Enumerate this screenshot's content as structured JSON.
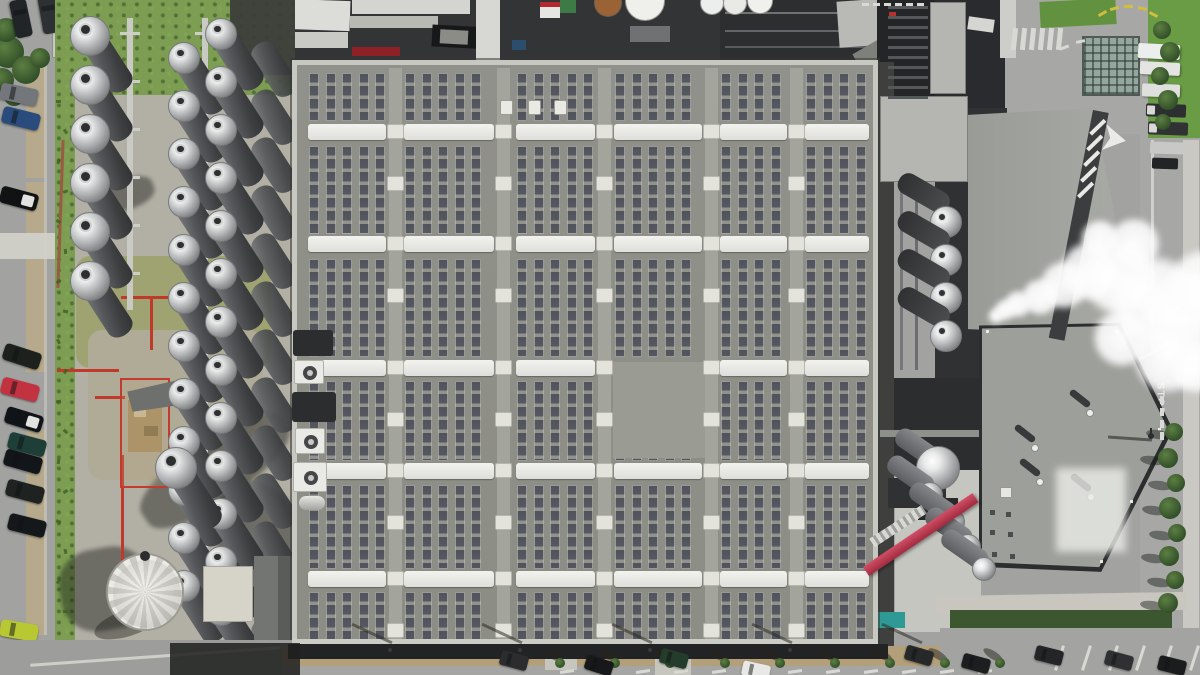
{
  "scene_label": "Aerial view of an industrial plant: large rooftop solar array, tank farm with silver storage tanks, steam plume, roads and parked cars",
  "road_markings": {
    "stop_label": "STOP"
  },
  "palette": {
    "asphalt": "#a2a3a1",
    "concrete": "#b2afa4",
    "grass": "#7c9d52",
    "roof": "#8f9087",
    "roof_border": "#c7c8c1",
    "panel": "#51535b",
    "skylight": "#efefec",
    "dark_ground": "#323436",
    "charcoal": "#27292c",
    "steam": "#ffffff",
    "red_accent": "#c0392b",
    "conveyor_pink": "#c2455e",
    "teal": "#2f9a95",
    "hedge": "#3c572f",
    "dirt": "#b3a07a",
    "right_roof": "#9d9f9a"
  },
  "left_road": {
    "cars": [
      [
        2,
        10,
        78,
        "#222527",
        0
      ],
      [
        30,
        6,
        80,
        "#2e3134",
        0
      ],
      [
        0,
        86,
        12,
        "#73767a",
        0
      ],
      [
        2,
        110,
        14,
        "#2a4c7c",
        0
      ],
      [
        0,
        190,
        15,
        "#101214",
        1
      ],
      [
        3,
        348,
        18,
        "#1c211e",
        0
      ],
      [
        1,
        381,
        15,
        "#c33240",
        0
      ],
      [
        5,
        411,
        17,
        "#101418",
        1
      ],
      [
        8,
        436,
        15,
        "#1d3f38",
        0
      ],
      [
        4,
        453,
        16,
        "#121519",
        0
      ],
      [
        6,
        483,
        15,
        "#1e2220",
        0
      ],
      [
        8,
        517,
        14,
        "#15181b",
        0
      ],
      [
        0,
        622,
        10,
        "#b7c832",
        0
      ],
      [
        0,
        656,
        8,
        "#dfe0dc",
        0
      ]
    ],
    "sidewalk_segments": [
      [
        26,
        60,
        20,
        118
      ],
      [
        26,
        182,
        20,
        190
      ],
      [
        26,
        430,
        20,
        205
      ]
    ],
    "walkway": [
      0,
      233,
      58,
      26
    ],
    "bushes": [
      [
        8,
        52,
        16
      ],
      [
        26,
        70,
        14
      ],
      [
        2,
        80,
        12
      ],
      [
        40,
        58,
        10
      ],
      [
        14,
        96,
        10
      ],
      [
        6,
        30,
        12
      ]
    ],
    "corner_building": [
      52,
      0,
      92,
      58
    ]
  },
  "tank_yard": {
    "grass_top": [
      55,
      0,
      240,
      95
    ],
    "grass_strip": [
      55,
      90,
      20,
      560
    ],
    "mid_patch_grass": [
      76,
      256,
      195,
      112
    ],
    "mid_patch_dirt": [
      88,
      330,
      175,
      150
    ],
    "columns": [
      {
        "cx": 90,
        "start_y": 36,
        "dy": 49,
        "count": 6,
        "r": 20
      },
      {
        "cx": 258,
        "start_y": 44,
        "dy": 48,
        "count": 13,
        "r": 0
      },
      {
        "cx": 184,
        "start_y": 58,
        "dy": 48,
        "count": 12,
        "r": 16
      },
      {
        "cx": 221,
        "start_y": 34,
        "dy": 48,
        "count": 13,
        "r": 16
      }
    ],
    "body": {
      "w": 27,
      "len": 64,
      "angle": -33
    },
    "big_horiz_tank": {
      "cx": 176,
      "cy": 468,
      "r": 21,
      "len": 70
    },
    "lattices": [
      [
        127,
        18,
        292
      ],
      [
        202,
        18,
        612
      ]
    ],
    "silo": {
      "cx": 145,
      "cy": 592,
      "r": 39
    },
    "shed_roof": [
      128,
      382,
      62,
      26,
      -8
    ],
    "red_enclosure": [
      120,
      378,
      50,
      110
    ],
    "clutter": [
      128,
      400,
      34,
      52
    ],
    "red_lines": [
      [
        57,
        369,
        62,
        3
      ],
      [
        95,
        396,
        30,
        3
      ],
      [
        121,
        296,
        86,
        3
      ],
      [
        150,
        296,
        3,
        54
      ],
      [
        121,
        455,
        3,
        108
      ]
    ],
    "rust_pipe": [
      59,
      140,
      3,
      148
    ],
    "pale_building": [
      203,
      566,
      50,
      56
    ],
    "gray_block": [
      254,
      556,
      40,
      88
    ],
    "dark_blocks": [
      [
        190,
        640,
        105,
        35
      ],
      [
        230,
        0,
        65,
        75
      ]
    ],
    "shadows": [
      [
        130,
        440,
        170,
        60,
        -35
      ],
      [
        60,
        548,
        90,
        82,
        -10
      ],
      [
        228,
        478,
        90,
        160,
        -30
      ],
      [
        95,
        180,
        60,
        30,
        -20
      ]
    ]
  },
  "solar_roof": {
    "x": 292,
    "y": 60,
    "w": 586,
    "h": 590,
    "skylight_rows": [
      124,
      236,
      360,
      463,
      571
    ],
    "skylight_h": 16,
    "pad_rows": [
      124,
      176,
      236,
      288,
      360,
      412,
      463,
      515,
      571,
      623
    ],
    "bands": [
      [
        73,
        121
      ],
      [
        146,
        234
      ],
      [
        259,
        357
      ],
      [
        381,
        461
      ],
      [
        485,
        569
      ],
      [
        592,
        642
      ]
    ],
    "blocks": [
      [
        307,
        387
      ],
      [
        403,
        495
      ],
      [
        515,
        596
      ],
      [
        613,
        703
      ],
      [
        719,
        788
      ],
      [
        804,
        870
      ]
    ],
    "walkways": [
      389,
      497,
      598,
      705,
      790
    ],
    "walkway_w": 13,
    "strip_pitch": 16.5,
    "strip_w": 10,
    "bare_patch": [
      613,
      362,
      92,
      96
    ],
    "bare_skylight": {
      "row": 2,
      "block": 3
    },
    "vents": [
      [
        500,
        100
      ],
      [
        528,
        100
      ],
      [
        554,
        100
      ]
    ],
    "hvac": [
      [
        293,
        330,
        40,
        26,
        "dark"
      ],
      [
        294,
        360,
        30,
        24,
        "fan"
      ],
      [
        292,
        392,
        44,
        30,
        "dark"
      ],
      [
        295,
        428,
        30,
        26,
        "fan"
      ],
      [
        293,
        462,
        34,
        30,
        "fan"
      ],
      [
        299,
        496,
        26,
        14,
        "tank"
      ]
    ]
  },
  "top_strip": {
    "base": [
      282,
      0,
      600,
      64
    ],
    "rects": [
      [
        286,
        0,
        64,
        30,
        "#dcddd8",
        2
      ],
      [
        292,
        32,
        56,
        16,
        "#c9cac5",
        0
      ],
      [
        352,
        0,
        118,
        14,
        "#d4d5d0",
        0
      ],
      [
        350,
        16,
        88,
        12,
        "#b8b9b4",
        0
      ],
      [
        352,
        47,
        48,
        9,
        "#8e2126",
        0
      ],
      [
        432,
        26,
        60,
        22,
        "#17181a",
        3
      ],
      [
        440,
        30,
        28,
        14,
        "#8b8c88",
        3
      ],
      [
        476,
        0,
        24,
        62,
        "#d7d8d3",
        0
      ],
      [
        512,
        40,
        14,
        10,
        "#2b4d6e",
        0
      ],
      [
        540,
        2,
        20,
        16,
        "#e6e7e3",
        0
      ],
      [
        540,
        2,
        20,
        5,
        "#b3282e",
        0
      ],
      [
        560,
        0,
        16,
        13,
        "#3e7a45",
        0
      ],
      [
        630,
        26,
        40,
        16,
        "#6f7173",
        0
      ],
      [
        720,
        0,
        158,
        62,
        "#2c2e30",
        0
      ],
      [
        725,
        12,
        150,
        2,
        "#6f7172",
        0
      ],
      [
        725,
        30,
        150,
        2,
        "#63656a",
        0
      ],
      [
        725,
        46,
        150,
        2,
        "#585a5e",
        0
      ],
      [
        838,
        0,
        50,
        46,
        "#b9bab5",
        -4
      ],
      [
        855,
        44,
        36,
        20,
        "#7e807c",
        -30
      ]
    ],
    "circles": [
      [
        608,
        3,
        14,
        "#9a6335"
      ],
      [
        645,
        1,
        20,
        "#eff0ec"
      ],
      [
        712,
        3,
        12,
        "#eceded"
      ],
      [
        735,
        3,
        12,
        "#e9eae6"
      ],
      [
        760,
        1,
        13,
        "#f0f1ed"
      ]
    ]
  },
  "right_area": {
    "rects": [
      [
        877,
        0,
        130,
        124,
        "#292b2e",
        0
      ],
      [
        877,
        0,
        58,
        108,
        "#232527",
        0
      ],
      [
        1005,
        0,
        195,
        134,
        "#a7a8a6",
        0
      ],
      [
        1140,
        120,
        60,
        555,
        "#a7a8a6",
        0
      ],
      [
        1183,
        140,
        16,
        520,
        "#c9c8c2",
        0
      ],
      [
        1040,
        0,
        76,
        26,
        "#62923f",
        -3
      ],
      [
        1148,
        0,
        52,
        138,
        "#6a9c45",
        0
      ],
      [
        1000,
        0,
        16,
        58,
        "#cdcec9",
        0
      ],
      [
        960,
        108,
        12,
        230,
        "#7b7d79",
        0
      ],
      [
        935,
        108,
        72,
        272,
        "#2f3133",
        0
      ],
      [
        878,
        378,
        127,
        96,
        "#2b2d2f",
        0
      ],
      [
        878,
        62,
        16,
        585,
        "#3f403e",
        0
      ],
      [
        900,
        120,
        3,
        250,
        "#75777a",
        0
      ],
      [
        915,
        150,
        3,
        220,
        "#6a6c6f",
        0
      ],
      [
        880,
        150,
        55,
        4,
        "#85878a",
        0
      ],
      [
        895,
        470,
        86,
        162,
        "#c6c6c0",
        0
      ],
      [
        888,
        478,
        58,
        30,
        "#2f3133",
        0
      ],
      [
        918,
        498,
        40,
        22,
        "#27292b",
        0
      ],
      [
        873,
        612,
        32,
        16,
        "#2f9a95",
        0
      ],
      [
        936,
        594,
        250,
        18,
        "#c8c6bf",
        -1
      ],
      [
        950,
        610,
        222,
        18,
        "#3c572f",
        0
      ],
      [
        1128,
        350,
        52,
        3,
        "#d5d6d2",
        -28
      ],
      [
        1151,
        140,
        3,
        215,
        "#cfd0cb",
        0
      ],
      [
        968,
        18,
        26,
        13,
        "#d5d6d2",
        8
      ],
      [
        889,
        12,
        7,
        7,
        "#b3332c",
        0
      ],
      [
        880,
        430,
        122,
        7,
        "#8e908b",
        0
      ]
    ],
    "lattice_rects": [
      [
        930,
        2,
        36,
        92
      ],
      [
        880,
        96,
        88,
        86
      ]
    ],
    "glass_building": [
      1082,
      36,
      58,
      60
    ],
    "trailers": [
      [
        1138,
        44,
        42,
        15,
        "#eceded",
        3
      ],
      [
        1140,
        62,
        40,
        13,
        "#e4e5e3",
        3
      ],
      [
        1142,
        84,
        38,
        13,
        "#dfe0de",
        2
      ]
    ],
    "trucks": [
      [
        1146,
        104,
        40,
        13,
        "#2c2e30",
        1
      ],
      [
        1148,
        122,
        40,
        13,
        "#303234",
        1
      ],
      [
        1150,
        142,
        34,
        12,
        "#c8c9c6",
        0
      ],
      [
        1152,
        158,
        26,
        11,
        "#222426",
        0
      ]
    ],
    "upper_roof": [
      968,
      108,
      172,
      228
    ],
    "lower_roof": [
      982,
      326,
      186,
      246
    ],
    "edge_band": {
      "x": 1093,
      "y": 110,
      "w": 16,
      "h": 232,
      "rot": 11
    },
    "spheres": {
      "cx": 946,
      "start_y": 222,
      "dy": 38,
      "count": 4,
      "r": 16
    },
    "lower_tanks": [
      [
        938,
        468,
        22
      ],
      [
        930,
        495,
        13
      ],
      [
        952,
        522,
        13
      ],
      [
        968,
        547,
        13
      ],
      [
        984,
        569,
        12
      ]
    ],
    "conveyor": {
      "x": 866,
      "y": 566,
      "w": 132,
      "h": 11,
      "rot": -34
    },
    "catwalk": {
      "x": 872,
      "y": 538,
      "w": 62,
      "h": 10,
      "rot": -33
    },
    "roof_vents": [
      [
        1090,
        413
      ],
      [
        1035,
        448
      ],
      [
        1040,
        482
      ],
      [
        1091,
        497
      ]
    ],
    "hatch_dots": [
      [
        990,
        510
      ],
      [
        1006,
        512
      ],
      [
        990,
        530
      ],
      [
        1008,
        532
      ],
      [
        992,
        552
      ],
      [
        1010,
        554
      ]
    ],
    "white_patch": [
      1056,
      468,
      70,
      84
    ],
    "edge_dots": [
      [
        986,
        330
      ],
      [
        1050,
        328
      ],
      [
        1115,
        330
      ],
      [
        1158,
        428
      ],
      [
        1130,
        500
      ],
      [
        1100,
        560
      ]
    ],
    "crosswalk": {
      "x": 1012,
      "y": 28,
      "step": 9,
      "count": 6
    },
    "yellow_dashes": [
      [
        1098,
        12,
        -30
      ],
      [
        1110,
        7,
        -15
      ],
      [
        1124,
        5,
        0
      ],
      [
        1138,
        7,
        14
      ],
      [
        1149,
        13,
        28
      ]
    ],
    "white_dashes_top": [
      [
        1060,
        46,
        -20
      ],
      [
        1076,
        40,
        -12
      ]
    ],
    "top_edge_dashes": {
      "x": 862,
      "y": 3,
      "step": 11,
      "count": 6
    },
    "green_trees_top": [
      [
        1162,
        30,
        9
      ],
      [
        1170,
        52,
        10
      ],
      [
        1160,
        76,
        9
      ],
      [
        1168,
        100,
        10
      ],
      [
        1163,
        122,
        8
      ]
    ],
    "road_trees": [
      [
        1174,
        432,
        9
      ],
      [
        1168,
        458,
        10
      ],
      [
        1176,
        483,
        9
      ],
      [
        1170,
        508,
        11
      ],
      [
        1177,
        533,
        9
      ],
      [
        1169,
        556,
        10
      ],
      [
        1175,
        580,
        9
      ],
      [
        1168,
        603,
        10
      ]
    ],
    "lamp": {
      "x": 1150,
      "y": 434
    },
    "stop_pos": [
      1141,
      396
    ],
    "yield_dashes": [
      [
        1160,
        396
      ],
      [
        1160,
        408
      ],
      [
        1160,
        420
      ],
      [
        1160,
        432
      ]
    ],
    "steam": [
      [
        996,
        316,
        8
      ],
      [
        1005,
        310,
        11
      ],
      [
        1018,
        304,
        14
      ],
      [
        1040,
        297,
        19
      ],
      [
        1064,
        285,
        25
      ],
      [
        1090,
        271,
        31
      ],
      [
        1120,
        279,
        38
      ],
      [
        1154,
        299,
        45
      ],
      [
        1186,
        318,
        48
      ],
      [
        1205,
        288,
        40
      ],
      [
        1134,
        244,
        27
      ],
      [
        1100,
        239,
        20
      ],
      [
        1168,
        358,
        36
      ],
      [
        1122,
        338,
        30
      ],
      [
        1196,
        368,
        26
      ]
    ]
  },
  "bottom": {
    "bl_road": [
      0,
      640,
      295,
      35
    ],
    "bl_line": [
      30,
      655,
      250,
      3
    ],
    "dirt": [
      282,
      646,
      680,
      29
    ],
    "road": [
      282,
      666,
      918,
      9
    ],
    "road_right": [
      940,
      628,
      260,
      47
    ],
    "dark_band": [
      288,
      644,
      600,
      15
    ],
    "parapet": [
      292,
      639,
      586,
      6
    ],
    "shadow_left": [
      170,
      643,
      130,
      32
    ],
    "pads": [
      [
        545,
        640,
        32,
        30
      ],
      [
        655,
        645,
        36,
        30
      ]
    ],
    "trees": {
      "start_x": 560,
      "step": 55,
      "count": 9,
      "y": 663
    },
    "pole_shadows": [
      390,
      520,
      650,
      790,
      920
    ],
    "divider_ticks": {
      "start_x": 560,
      "step": 38,
      "count": 12,
      "y": 670
    },
    "parking_lines": {
      "start_x": 1058,
      "step": 27,
      "count": 6,
      "y": 645
    },
    "cars": [
      [
        500,
        653,
        15,
        "#2a2c2e"
      ],
      [
        585,
        658,
        18,
        "#17181a"
      ],
      [
        660,
        651,
        15,
        "#233c2b"
      ],
      [
        742,
        663,
        12,
        "#e8e8e6"
      ],
      [
        905,
        648,
        16,
        "#26282a"
      ],
      [
        962,
        656,
        15,
        "#1c1e20"
      ],
      [
        1035,
        648,
        14,
        "#232527"
      ],
      [
        1105,
        653,
        15,
        "#2e3032"
      ],
      [
        1158,
        658,
        14,
        "#1a1c1e"
      ]
    ]
  }
}
